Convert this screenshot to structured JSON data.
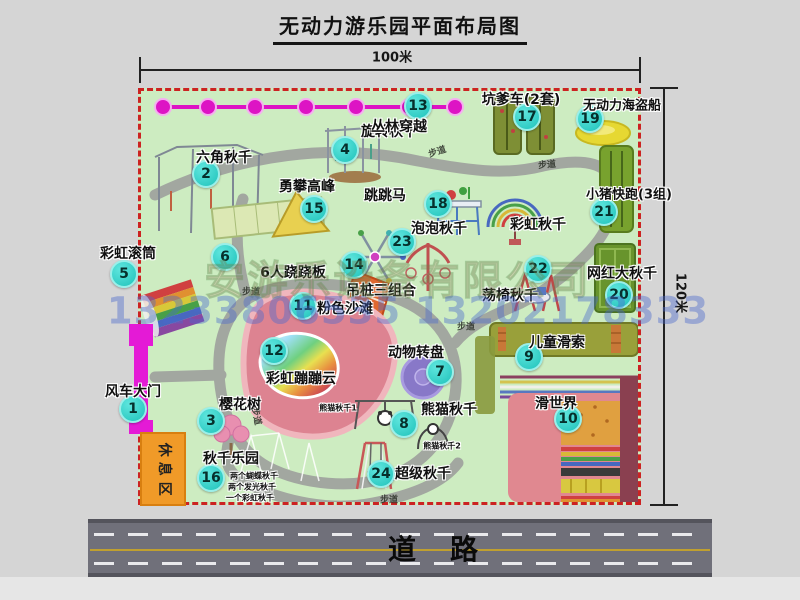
{
  "title": "无动力游乐园平面布局图",
  "dimensions": {
    "width_label": "100米",
    "height_label": "120米"
  },
  "road": {
    "label": "道路"
  },
  "rest_area": {
    "label": "休息区"
  },
  "watermark": {
    "company": "安游乐设备有限公司",
    "phones": "13233806535 13202178333"
  },
  "colors": {
    "park_green": "#cdecc1",
    "boundary_red": "#cc2222",
    "badge_teal": "#1fc2ba",
    "path_gray": "#a2a7a0",
    "gate_magenta": "#e41ad6",
    "zipline_magenta": "#dd14c4",
    "beach_pink": "#dd8391",
    "road_gray": "#70707a",
    "rest_orange": "#f09a28"
  },
  "map": {
    "attractions": [
      {
        "n": "1",
        "label": "风车大门",
        "lx": 133,
        "ly": 391,
        "bx": 133,
        "by": 409,
        "size": 14
      },
      {
        "n": "2",
        "label": "六角秋千",
        "lx": 224,
        "ly": 157,
        "bx": 206,
        "by": 174,
        "size": 14
      },
      {
        "n": "3",
        "label": "樱花树",
        "lx": 240,
        "ly": 404,
        "bx": 211,
        "by": 421,
        "size": 14
      },
      {
        "n": "4",
        "label": "旋转秋千",
        "lx": 389,
        "ly": 131,
        "bx": 345,
        "by": 150,
        "size": 14
      },
      {
        "n": "5",
        "label": "彩虹滚筒",
        "lx": 128,
        "ly": 253,
        "bx": 124,
        "by": 274,
        "size": 14
      },
      {
        "n": "6",
        "label": "6人跷跷板",
        "lx": 293,
        "ly": 272,
        "bx": 225,
        "by": 257,
        "size": 14
      },
      {
        "n": "7",
        "label": "动物转盘",
        "lx": 416,
        "ly": 352,
        "bx": 440,
        "by": 372,
        "size": 14
      },
      {
        "n": "8",
        "label": "熊猫秋千",
        "lx": 449,
        "ly": 409,
        "bx": 404,
        "by": 424,
        "size": 14
      },
      {
        "n": "9",
        "label": "儿童滑索",
        "lx": 557,
        "ly": 342,
        "bx": 529,
        "by": 357,
        "size": 14
      },
      {
        "n": "10",
        "label": "滑世界",
        "lx": 556,
        "ly": 403,
        "bx": 568,
        "by": 419,
        "size": 14
      },
      {
        "n": "11",
        "label": "粉色沙滩",
        "lx": 345,
        "ly": 308,
        "bx": 303,
        "by": 306,
        "size": 14
      },
      {
        "n": "12",
        "label": "彩虹蹦蹦云",
        "lx": 301,
        "ly": 378,
        "bx": 274,
        "by": 351,
        "size": 14
      },
      {
        "n": "13",
        "label": "丛林穿越",
        "lx": 399,
        "ly": 126,
        "bx": 418,
        "by": 106,
        "size": 14
      },
      {
        "n": "14",
        "label": "吊桩三组合",
        "lx": 381,
        "ly": 290,
        "bx": 354,
        "by": 265,
        "size": 14
      },
      {
        "n": "15",
        "label": "勇攀高峰",
        "lx": 307,
        "ly": 186,
        "bx": 314,
        "by": 209,
        "size": 14
      },
      {
        "n": "16",
        "label": "秋千乐园",
        "lx": 231,
        "ly": 458,
        "bx": 211,
        "by": 478,
        "size": 14
      },
      {
        "n": "17",
        "label": "坑爹车(2套)",
        "lx": 521,
        "ly": 99,
        "bx": 527,
        "by": 117,
        "size": 14
      },
      {
        "n": "18",
        "label": "跳跳马",
        "lx": 385,
        "ly": 195,
        "bx": 438,
        "by": 204,
        "size": 14
      },
      {
        "n": "19",
        "label": "无动力海盗船",
        "lx": 622,
        "ly": 104,
        "bx": 590,
        "by": 119,
        "size": 13
      },
      {
        "n": "20",
        "label": "网红大秋千",
        "lx": 622,
        "ly": 273,
        "bx": 619,
        "by": 295,
        "size": 14
      },
      {
        "n": "21",
        "label": "小猪快跑(3组)",
        "lx": 629,
        "ly": 193,
        "bx": 604,
        "by": 212,
        "size": 13
      },
      {
        "n": "22",
        "label": "荡椅秋千",
        "lx": 510,
        "ly": 295,
        "bx": 538,
        "by": 269,
        "size": 14
      },
      {
        "n": "23",
        "label": "泡泡秋千",
        "lx": 439,
        "ly": 228,
        "bx": 402,
        "by": 242,
        "size": 14
      },
      {
        "n": "24",
        "label": "超级秋千",
        "lx": 423,
        "ly": 473,
        "bx": 381,
        "by": 474,
        "size": 14
      }
    ],
    "extra_labels": [
      {
        "text": "彩虹秋千",
        "x": 538,
        "y": 224,
        "size": 14
      },
      {
        "text": "熊猫秋千1",
        "x": 338,
        "y": 408,
        "size": 8
      },
      {
        "text": "熊猫秋千2",
        "x": 442,
        "y": 446,
        "size": 8
      },
      {
        "text": "两个蝴蝶秋千",
        "x": 254,
        "y": 476,
        "size": 8
      },
      {
        "text": "两个发光秋千",
        "x": 252,
        "y": 487,
        "size": 8
      },
      {
        "text": "一个彩虹秋千",
        "x": 250,
        "y": 498,
        "size": 8
      }
    ],
    "walkway_labels": [
      {
        "text": "步道",
        "x": 437,
        "y": 151,
        "rot": -18
      },
      {
        "text": "步道",
        "x": 547,
        "y": 164,
        "rot": -5
      },
      {
        "text": "步道",
        "x": 251,
        "y": 291,
        "rot": 0
      },
      {
        "text": "步道",
        "x": 257,
        "y": 416,
        "rot": 78
      },
      {
        "text": "步道",
        "x": 389,
        "y": 499,
        "rot": 0
      },
      {
        "text": "步道",
        "x": 466,
        "y": 326,
        "rot": 0
      }
    ]
  }
}
